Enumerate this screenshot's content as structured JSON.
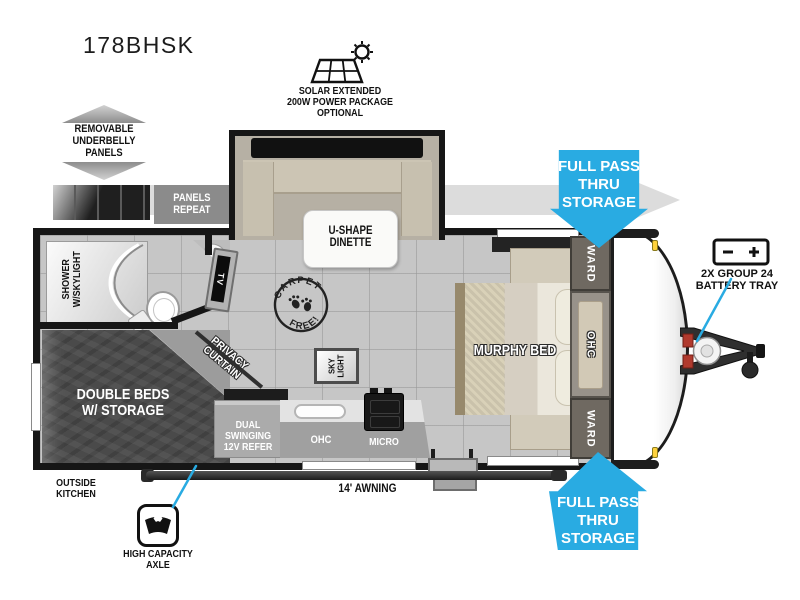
{
  "title": "178BHSK",
  "colors": {
    "accent_blue": "#29abe2",
    "wall_black": "#161616",
    "floor_gray": "#c6c6c6",
    "bed_charcoal": "#4a4a4a",
    "arrow_gray": "#dcdcdc"
  },
  "callouts": {
    "solar": "SOLAR EXTENDED\n200W POWER PACKAGE\nOPTIONAL",
    "underbelly": "REMOVABLE\nUNDERBELLY\nPANELS",
    "panels_repeat": "PANELS\nREPEAT",
    "pass_thru_top": "FULL PASS\nTHRU\nSTORAGE",
    "pass_thru_bottom": "FULL PASS\nTHRU\nSTORAGE",
    "battery": "2X GROUP 24\nBATTERY TRAY",
    "axle": "HIGH CAPACITY\nAXLE",
    "awning": "14' AWNING",
    "outside_kitchen": "OUTSIDE\nKITCHEN"
  },
  "floorplan": {
    "dinette": "U-SHAPE\nDINETTE",
    "shower": "SHOWER\nW/SKYLIGHT",
    "tv": "TV",
    "privacy_curtain": "PRIVACY\nCURTAIN",
    "carpet_free_top": "CARPET",
    "carpet_free_bottom": "FREE!",
    "sky_light": "SKY\nLIGHT",
    "murphy_bed": "MURPHY BED",
    "ward_top": "WARD",
    "ohc_front": "OHC",
    "ward_bottom": "WARD",
    "double_beds": "DOUBLE BEDS\nW/ STORAGE",
    "refer": "DUAL SWINGING\n12V REFER",
    "ohc_kitchen": "OHC",
    "micro": "MICRO"
  }
}
